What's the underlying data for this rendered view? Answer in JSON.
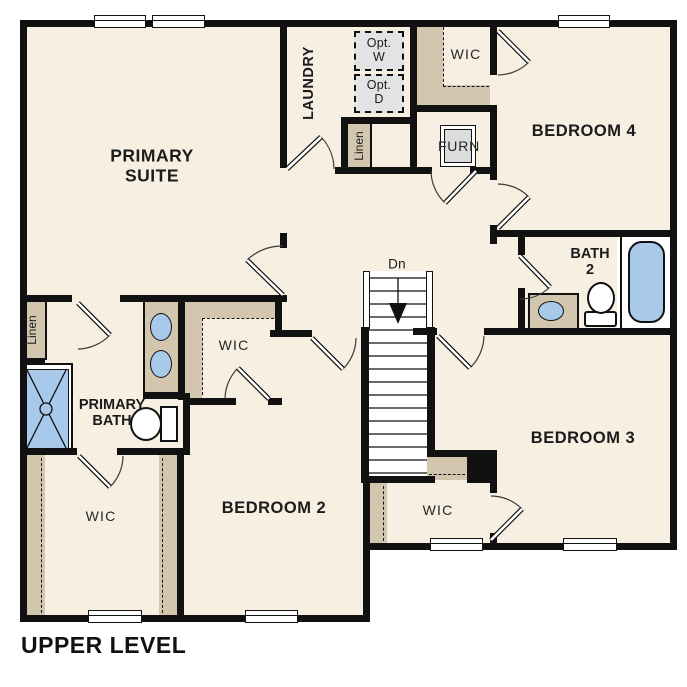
{
  "title": "UPPER LEVEL",
  "labels": {
    "primary_suite": "PRIMARY SUITE",
    "laundry": "LAUNDRY",
    "opt_w": "Opt. W",
    "opt_d": "Opt. D",
    "wic_top": "WIC",
    "bedroom4": "BEDROOM 4",
    "furn": "FURN",
    "linen_laundry": "Linen",
    "bath2": "BATH 2",
    "dn": "Dn",
    "linen_primary": "Linen",
    "primary_bath": "PRIMARY BATH",
    "wic_mid": "WIC",
    "bedroom2": "BEDROOM 2",
    "bedroom3": "BEDROOM 3",
    "wic_bottom_left": "WIC",
    "wic_bottom_right": "WIC"
  },
  "rooms": [
    "PRIMARY SUITE",
    "LAUNDRY",
    "WIC",
    "BEDROOM 4",
    "BATH 2",
    "BEDROOM 3",
    "BEDROOM 2",
    "PRIMARY BATH",
    "WIC",
    "WIC",
    "WIC",
    "Linen",
    "Linen",
    "FURN"
  ],
  "fixtures": {
    "shower": "walk-in shower",
    "tub": "bathtub",
    "toilets": 2,
    "sinks": 3,
    "washer_optional": "Opt. W",
    "dryer_optional": "Opt. D",
    "furnace": "FURN",
    "stairs_direction": "Dn"
  },
  "counts": {
    "windows": 7,
    "doors": 12
  },
  "colors": {
    "wall": "#111111",
    "floor": "#f6efe2",
    "shelf_tan": "#d2c7ae",
    "fixture_blue": "#a8c9e9",
    "appliance_gray": "#e3e3e3",
    "background": "#ffffff"
  }
}
